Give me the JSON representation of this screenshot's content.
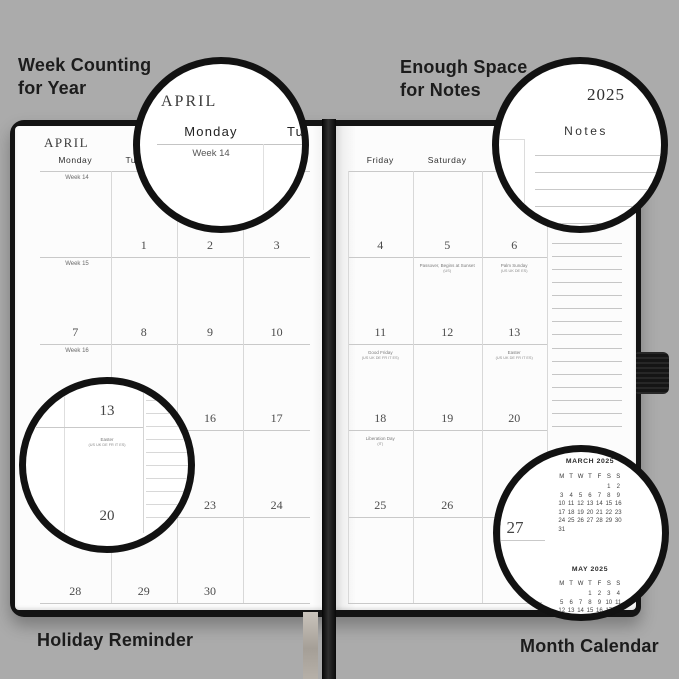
{
  "labels": {
    "top_left_line1": "Week Counting",
    "top_left_line2": "for Year",
    "top_right_line1": "Enough Space",
    "top_right_line2": "for Notes",
    "bottom_left": "Holiday Reminder",
    "bottom_right": "Month Calendar"
  },
  "left_page": {
    "month_title": "APRIL",
    "day_headers": [
      "Monday",
      "Tuesday",
      "Wednesday",
      "Thursday"
    ],
    "week_labels": [
      "Week 14",
      "Week 15",
      "Week 16",
      "Week 17",
      "Week 18"
    ],
    "date_rows": [
      [
        "",
        "1",
        "2",
        "3"
      ],
      [
        "7",
        "8",
        "9",
        "10"
      ],
      [
        "14",
        "15",
        "16",
        "17"
      ],
      [
        "21",
        "22",
        "23",
        "24"
      ],
      [
        "28",
        "29",
        "30",
        ""
      ]
    ]
  },
  "right_page": {
    "day_headers": [
      "Friday",
      "Saturday",
      "Sunday"
    ],
    "date_rows": [
      [
        "4",
        "5",
        "6"
      ],
      [
        "11",
        "12",
        "13"
      ],
      [
        "18",
        "19",
        "20"
      ],
      [
        "25",
        "26",
        "27"
      ],
      [
        "",
        "",
        ""
      ]
    ],
    "holidays": [
      {
        "row": 1,
        "col": 1,
        "name": "Passover, Begins at Sunset",
        "countries": "(US)"
      },
      {
        "row": 1,
        "col": 2,
        "name": "Palm Sunday",
        "countries": "(US UK DE ES)"
      },
      {
        "row": 2,
        "col": 0,
        "name": "Good Friday",
        "countries": "(US UK DE FR IT ES)"
      },
      {
        "row": 2,
        "col": 2,
        "name": "Easter",
        "countries": "(US UK DE FR IT ES)"
      },
      {
        "row": 3,
        "col": 0,
        "name": "Liberation Day",
        "countries": "(IT)"
      }
    ],
    "year": "2025",
    "notes_title": "Notes"
  },
  "magnifiers": {
    "top_left": {
      "month": "APRIL",
      "day": "Monday",
      "day_partial": "Tu",
      "week": "Week 14"
    },
    "top_right": {
      "year": "2025",
      "notes": "Notes"
    },
    "bottom_left": {
      "date_top": "13",
      "holiday": "Easter",
      "countries": "(US UK DE FR IT ES)",
      "date_bottom": "20"
    },
    "bottom_right": {
      "date": "27"
    }
  },
  "mini_calendars": [
    {
      "title": "MARCH 2025",
      "day_header": [
        "M",
        "T",
        "W",
        "T",
        "F",
        "S",
        "S"
      ],
      "rows": [
        [
          "",
          "",
          "",
          "",
          "",
          "1",
          "2"
        ],
        [
          "3",
          "4",
          "5",
          "6",
          "7",
          "8",
          "9"
        ],
        [
          "10",
          "11",
          "12",
          "13",
          "14",
          "15",
          "16"
        ],
        [
          "17",
          "18",
          "19",
          "20",
          "21",
          "22",
          "23"
        ],
        [
          "24",
          "25",
          "26",
          "27",
          "28",
          "29",
          "30"
        ],
        [
          "31",
          "",
          "",
          "",
          "",
          "",
          ""
        ]
      ]
    },
    {
      "title": "MAY 2025",
      "day_header": [
        "M",
        "T",
        "W",
        "T",
        "F",
        "S",
        "S"
      ],
      "rows": [
        [
          "",
          "",
          "",
          "1",
          "2",
          "3",
          "4"
        ],
        [
          "5",
          "6",
          "7",
          "8",
          "9",
          "10",
          "11"
        ],
        [
          "12",
          "13",
          "14",
          "15",
          "16",
          "17",
          "18"
        ],
        [
          "19",
          "20",
          "21",
          "22",
          "23",
          "24",
          "25"
        ],
        [
          "26",
          "27",
          "28",
          "29",
          "30",
          "31",
          ""
        ]
      ]
    }
  ],
  "colors": {
    "background": "#ababab",
    "cover": "#141414",
    "page": "#fcfcfc",
    "label_text": "#1c1c1c",
    "grid_line": "#c9c9c9"
  }
}
